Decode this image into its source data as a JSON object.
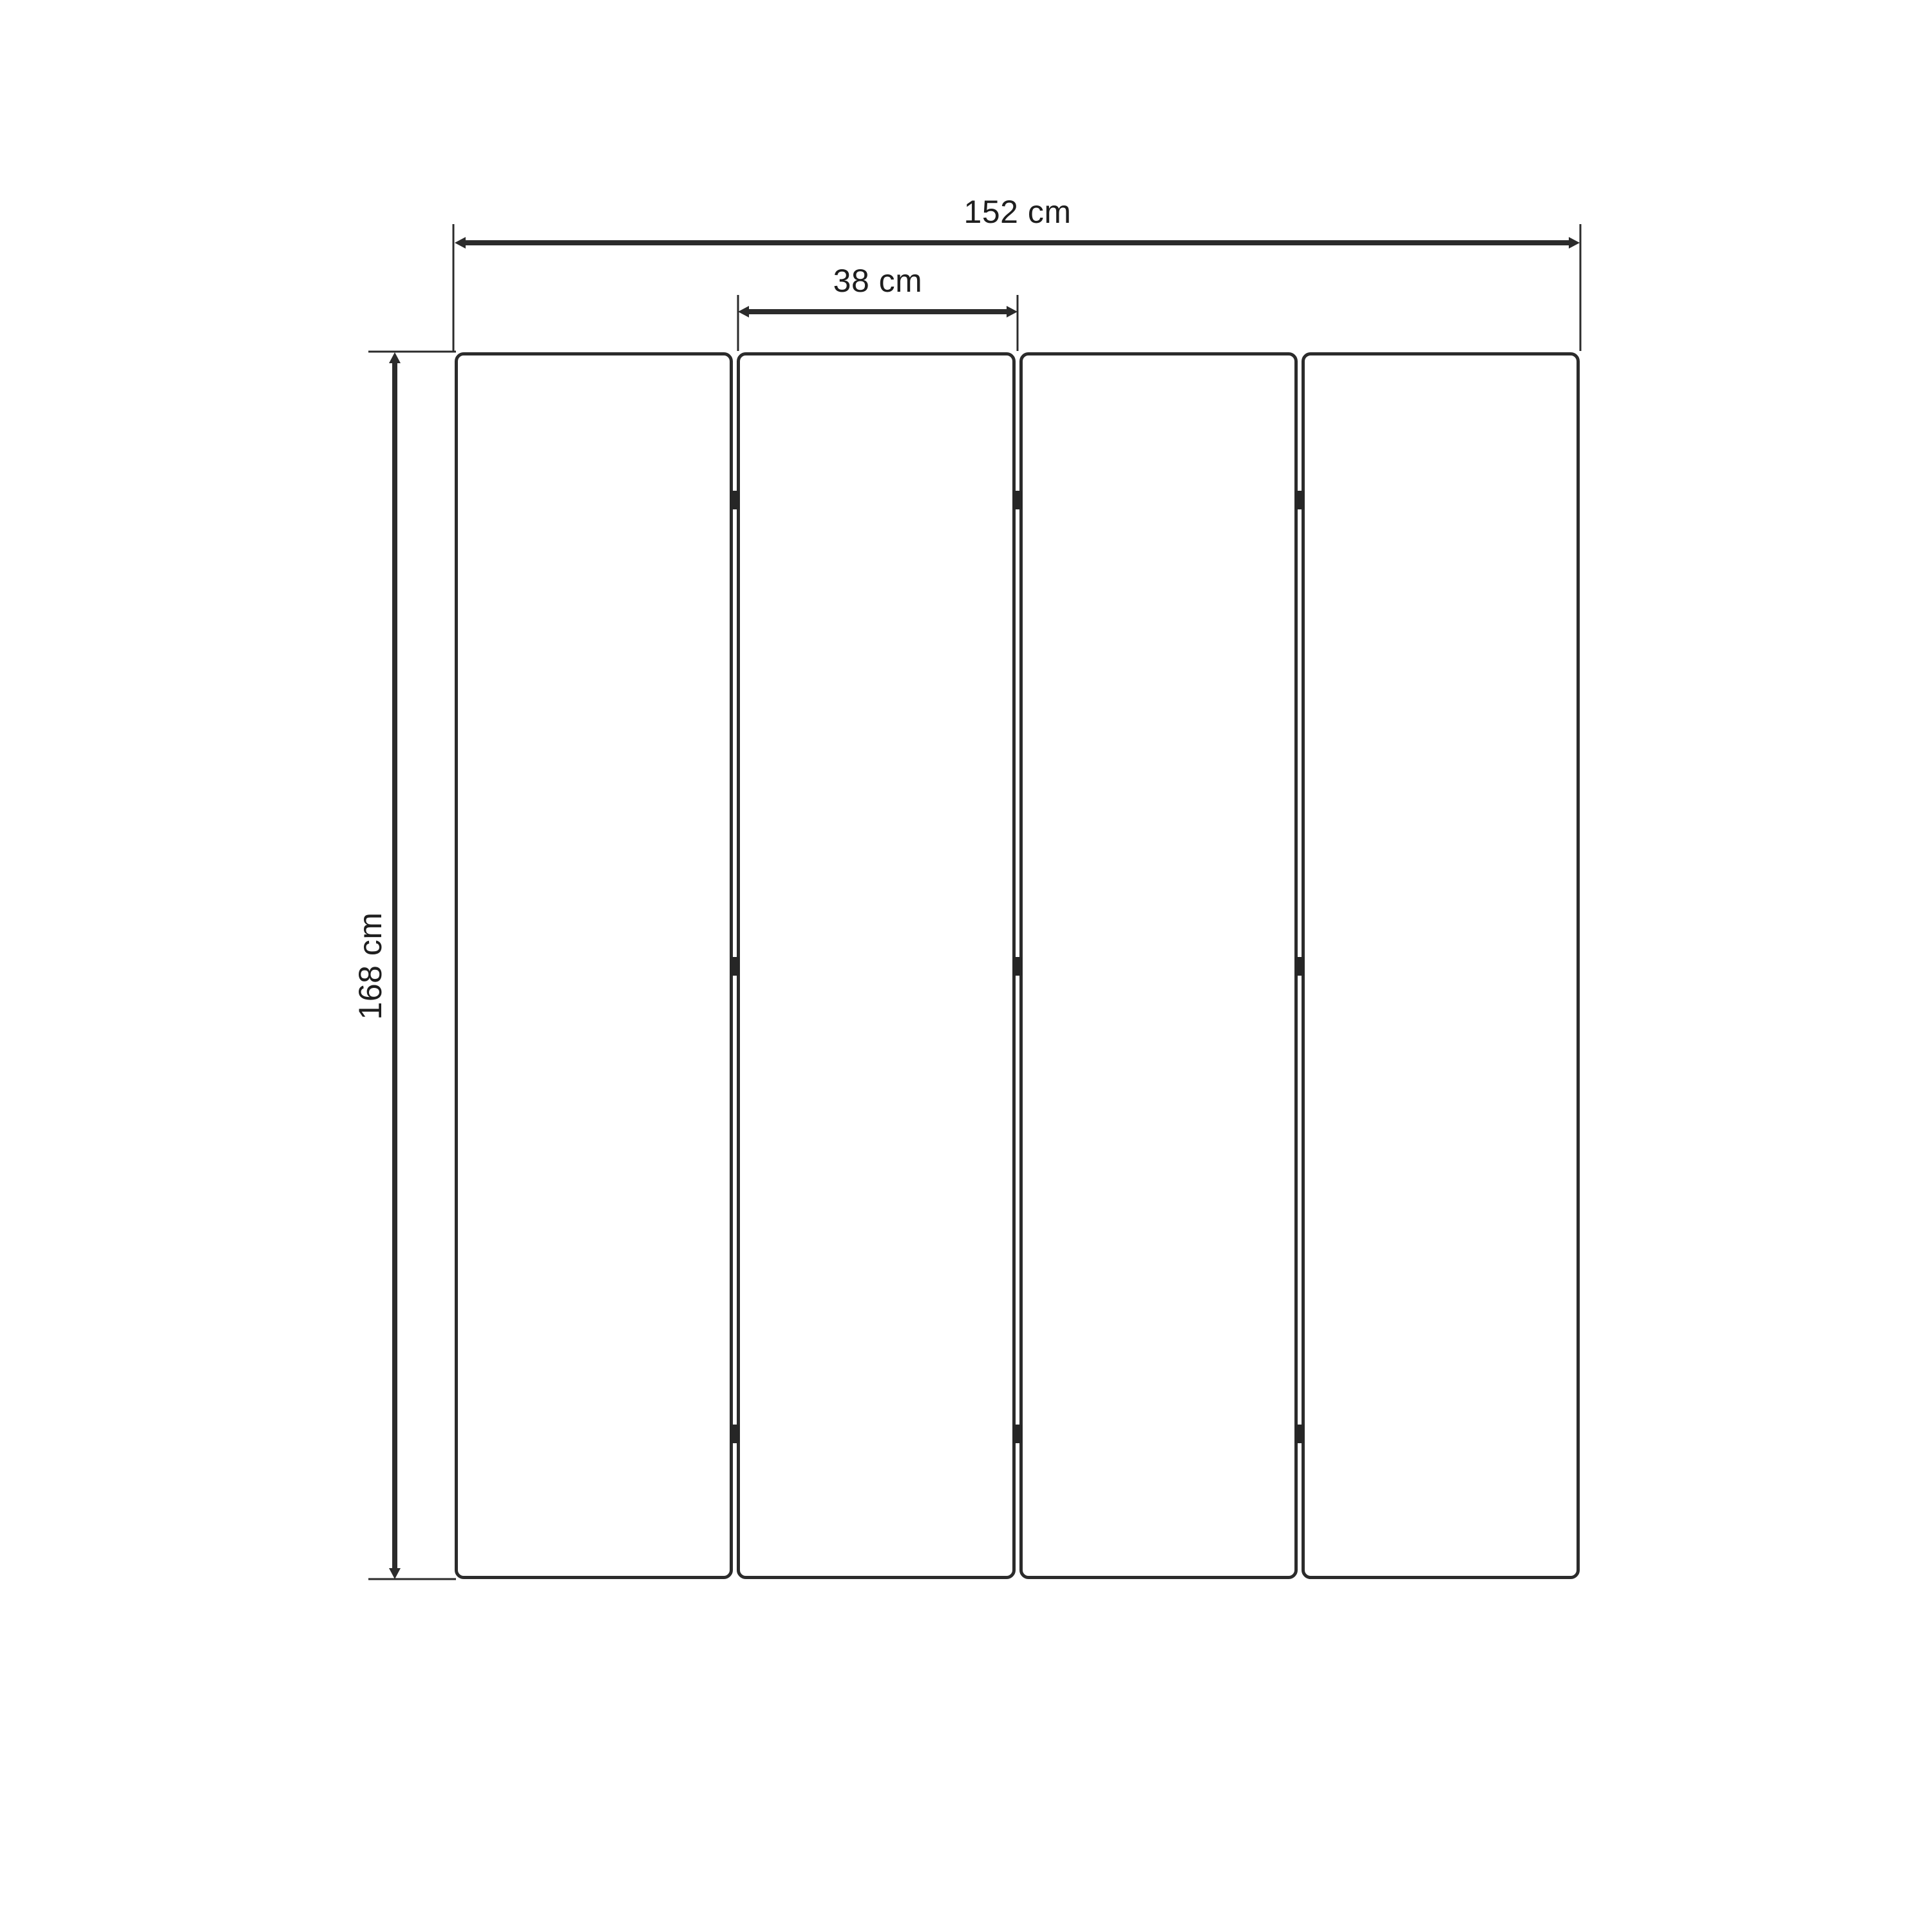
{
  "diagram": {
    "type": "dimension-drawing",
    "subject": "4-panel folding screen, front elevation",
    "unit": "cm",
    "panel_count": 4,
    "labels": {
      "total_width": "152 cm",
      "panel_width": "38 cm",
      "height": "168 cm"
    },
    "values": {
      "total_width_cm": 152,
      "panel_width_cm": 38,
      "height_cm": 168
    },
    "colors": {
      "line": "#2b2b2b",
      "background": "#ffffff",
      "panel_fill": "#ffffff",
      "text": "#1e1e1e"
    }
  }
}
